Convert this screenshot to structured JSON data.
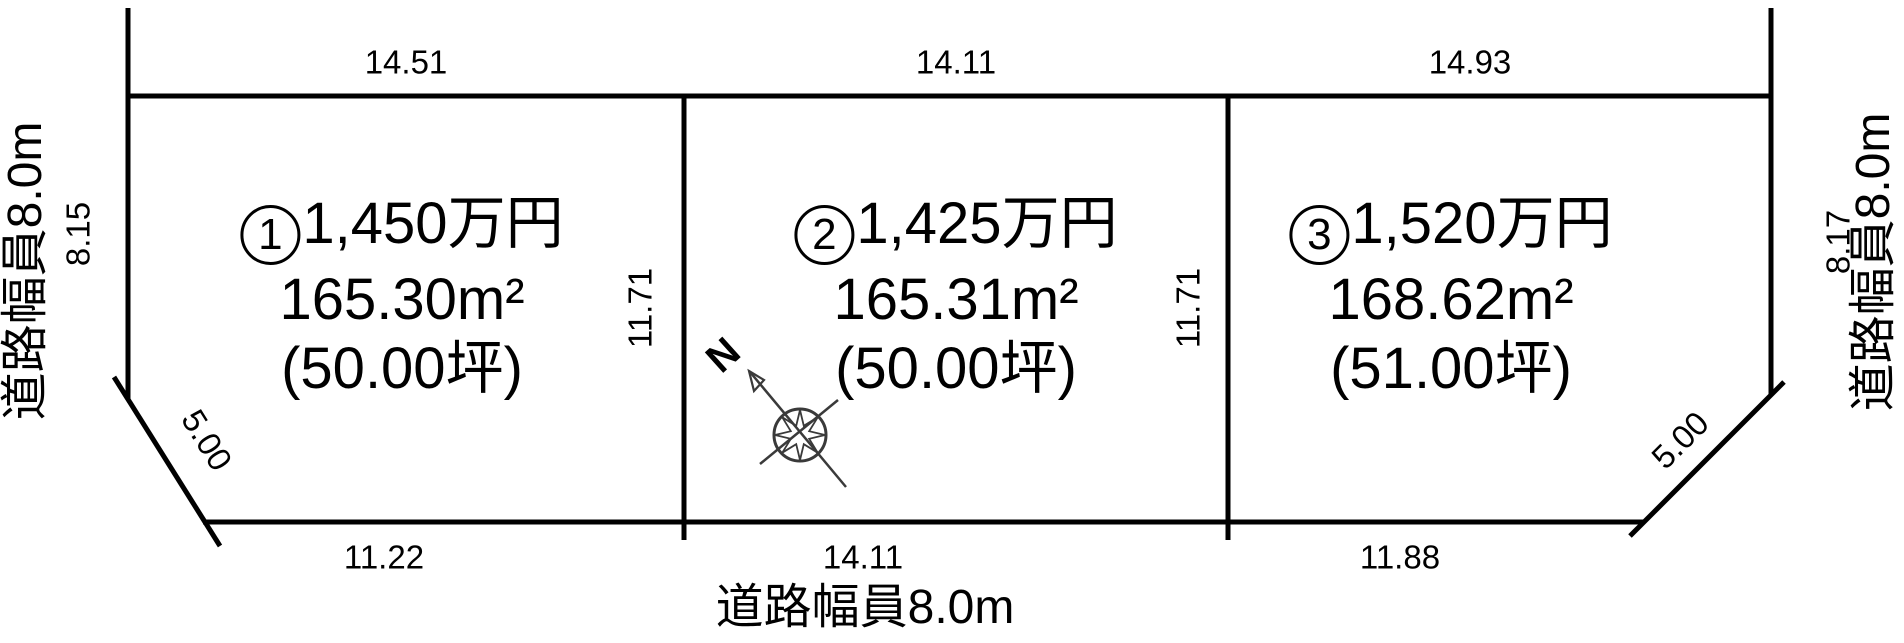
{
  "lots": [
    {
      "number": "1",
      "price": "1,450万円",
      "area_m2": "165.30m²",
      "area_tsubo": "(50.00坪)",
      "top_dim": "14.51",
      "side_dim": "11.71",
      "bottom_dim": "11.22"
    },
    {
      "number": "2",
      "price": "1,425万円",
      "area_m2": "165.31m²",
      "area_tsubo": "(50.00坪)",
      "top_dim": "14.11",
      "side_dim": "11.71",
      "bottom_dim": "14.11"
    },
    {
      "number": "3",
      "price": "1,520万円",
      "area_m2": "168.62m²",
      "area_tsubo": "(51.00坪)",
      "top_dim": "14.93",
      "bottom_dim": "11.88"
    }
  ],
  "roads": {
    "left": {
      "label": "道路幅員8.0m",
      "frontage_dim": "8.15"
    },
    "right": {
      "label": "道路幅員8.0m",
      "frontage_dim": "8.17"
    },
    "bottom": {
      "label": "道路幅員8.0m"
    }
  },
  "corner_cuts": {
    "left_dim": "5.00",
    "right_dim": "5.00"
  },
  "compass": {
    "north_label": "N"
  },
  "colors": {
    "line": "#000000",
    "compass": "#3a3a3a",
    "background": "#ffffff"
  }
}
